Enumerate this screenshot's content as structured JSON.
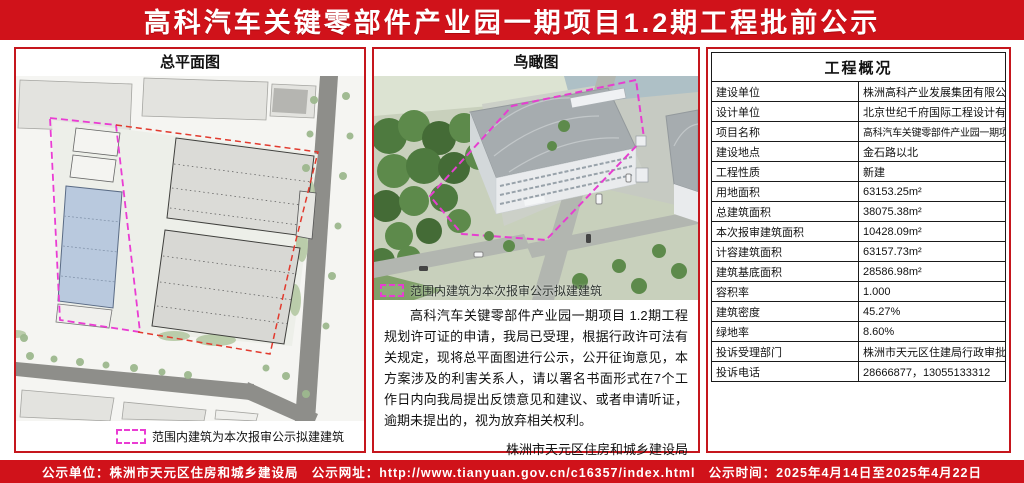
{
  "title": "高科汽车关键零部件产业园一期项目1.2期工程批前公示",
  "site_plan_panel": {
    "title": "总平面图",
    "legend_text": "范围内建筑为本次报审公示拟建建筑"
  },
  "aerial_panel": {
    "title": "鸟瞰图",
    "legend_text": "范围内建筑为本次报审公示拟建建筑",
    "notice_paragraph": "高科汽车关键零部件产业园一期项目 1.2期工程规划许可证的申请，我局已受理，根据行政许可法有关规定，现将总平面图进行公示，公开征询意见，本方案涉及的利害关系人，请以署名书面形式在7个工作日内向我局提出反馈意见和建议、或者申请听证，逾期未提出的，视为放弃相关权利。",
    "issuer": "株洲市天元区住房和城乡建设局",
    "issue_date": "2025年4月14日"
  },
  "overview_table": {
    "title": "工程概况",
    "rows": [
      {
        "label": "建设单位",
        "value": "株洲高科产业发展集团有限公司"
      },
      {
        "label": "设计单位",
        "value": "北京世纪千府国际工程设计有限公司"
      },
      {
        "label": "项目名称",
        "value": "高科汽车关键零部件产业园一期项目1.2期工程"
      },
      {
        "label": "建设地点",
        "value": "金石路以北"
      },
      {
        "label": "工程性质",
        "value": "新建"
      },
      {
        "label": "用地面积",
        "value": "63153.25m²"
      },
      {
        "label": "总建筑面积",
        "value": "38075.38m²"
      },
      {
        "label": "本次报审建筑面积",
        "value": "10428.09m²"
      },
      {
        "label": "计容建筑面积",
        "value": "63157.73m²"
      },
      {
        "label": "建筑基底面积",
        "value": "28586.98m²"
      },
      {
        "label": "容积率",
        "value": "1.000"
      },
      {
        "label": "建筑密度",
        "value": "45.27%"
      },
      {
        "label": "绿地率",
        "value": "8.60%"
      },
      {
        "label": "投诉受理部门",
        "value": "株洲市天元区住建局行政审批股"
      },
      {
        "label": "投诉电话",
        "value": "28666877，13055133312"
      }
    ]
  },
  "footer": {
    "unit_label": "公示单位：",
    "unit_value": "株洲市天元区住房和城乡建设局",
    "url_label": "公示网址：",
    "url_value": "http://www.tianyuan.gov.cn/c16357/index.html",
    "time_label": "公示时间：",
    "time_value": "2025年4月14日至2025年4月22日"
  },
  "colors": {
    "banner_red": "#d0121a",
    "panel_border_red": "#c5161d",
    "boundary_magenta": "#ea3cd3",
    "boundary_red": "#e23a2e",
    "highlight_building_blue": "#b9c9de"
  }
}
